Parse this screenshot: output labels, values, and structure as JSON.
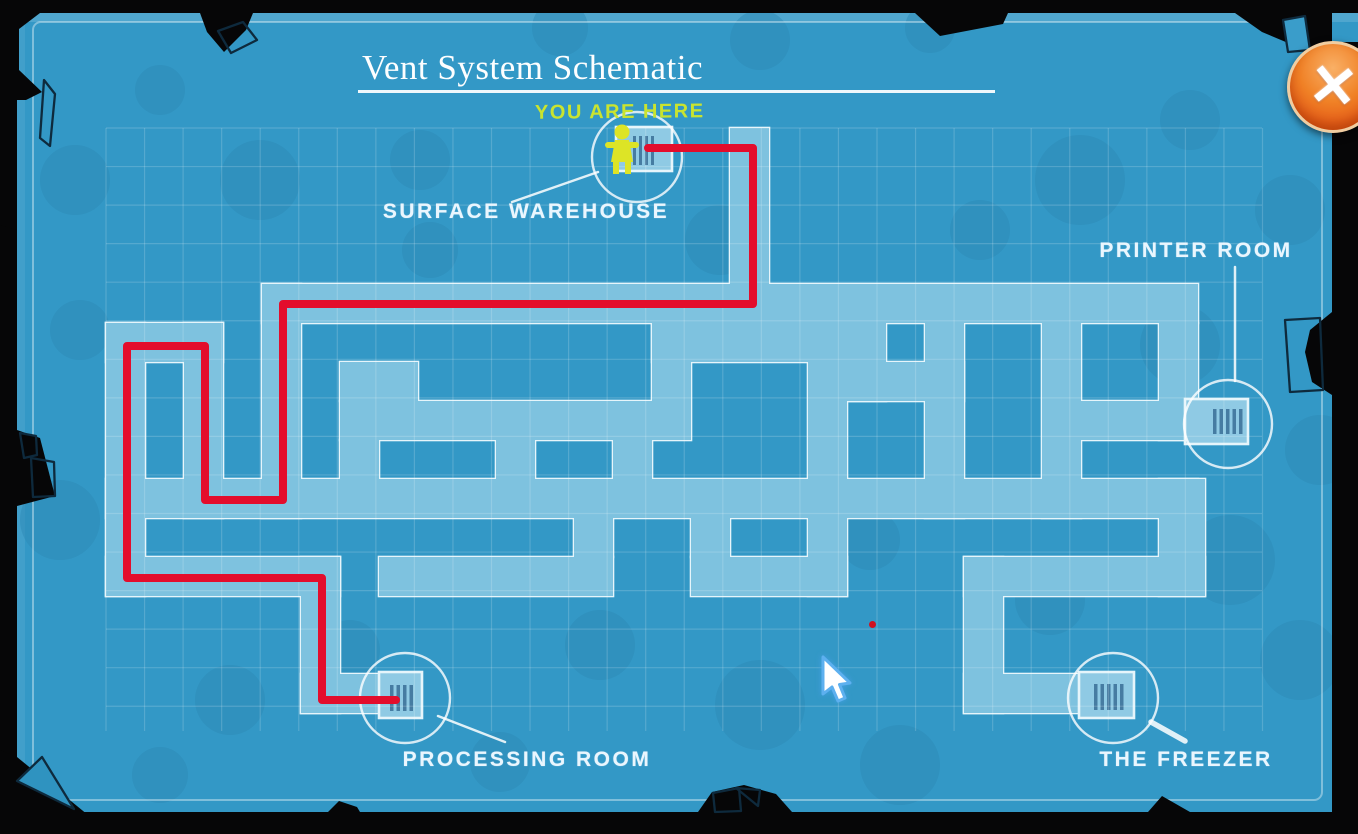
{
  "title": "Vent System Schematic",
  "you_are_here_label": "YOU ARE HERE",
  "rooms": {
    "surface_warehouse": "SURFACE WAREHOUSE",
    "printer_room": "PRINTER ROOM",
    "processing_room": "PROCESSING ROOM",
    "the_freezer": "THE FREEZER"
  },
  "close_button": {
    "symbol": "✕"
  },
  "colors": {
    "sheet": "#3398c6",
    "blob": "#2d89b6",
    "corridor": "#7ec2df",
    "corridor_outline": "#e6f5fb",
    "grid": "rgba(255,255,255,0.17)",
    "vent_fill": "#8fcae4",
    "slat": "#3a6e96",
    "circle_stroke": "rgba(255,255,255,0.8)",
    "route_red": "#e30d2c",
    "label_white": "#eaf6fe",
    "you_are_here_green": "#c9e42f",
    "close_orange": "#f08126",
    "black_edge": "#060607",
    "character_green": "#dde426"
  },
  "maze": {
    "corridors": [
      [
        730,
        128,
        39,
        195
      ],
      [
        262,
        284,
        936,
        39
      ],
      [
        262,
        284,
        39,
        234
      ],
      [
        106,
        323,
        117,
        39
      ],
      [
        106,
        323,
        39,
        273
      ],
      [
        184,
        323,
        39,
        195
      ],
      [
        340,
        362,
        78,
        39
      ],
      [
        340,
        401,
        312,
        39
      ],
      [
        652,
        323,
        39,
        117
      ],
      [
        652,
        323,
        195,
        39
      ],
      [
        808,
        362,
        39,
        234
      ],
      [
        847,
        323,
        39,
        78
      ],
      [
        847,
        362,
        117,
        39
      ],
      [
        925,
        323,
        39,
        195
      ],
      [
        1042,
        323,
        39,
        195
      ],
      [
        1159,
        323,
        39,
        117
      ],
      [
        1081,
        401,
        104,
        39
      ],
      [
        106,
        479,
        1092,
        39
      ],
      [
        340,
        440,
        39,
        39
      ],
      [
        496,
        440,
        39,
        39
      ],
      [
        613,
        440,
        39,
        39
      ],
      [
        574,
        518,
        39,
        39
      ],
      [
        691,
        518,
        39,
        39
      ],
      [
        106,
        557,
        234,
        39
      ],
      [
        301,
        557,
        39,
        156
      ],
      [
        301,
        674,
        117,
        39
      ],
      [
        379,
        557,
        234,
        39
      ],
      [
        691,
        557,
        156,
        39
      ],
      [
        964,
        557,
        241,
        39
      ],
      [
        1159,
        479,
        46,
        117
      ],
      [
        964,
        557,
        39,
        156
      ],
      [
        964,
        674,
        117,
        39
      ]
    ],
    "vent_squares": [
      {
        "id": "surface-warehouse",
        "rect": [
          616,
          127,
          56,
          44
        ],
        "slats": [
          633,
          136,
          3,
          29,
          4,
          6
        ]
      },
      {
        "id": "printer-room",
        "rect": [
          1185,
          399,
          63,
          45
        ],
        "slats": [
          1213,
          409,
          3.5,
          25,
          5,
          6.5
        ]
      },
      {
        "id": "processing-room",
        "rect": [
          379,
          672,
          43,
          46
        ],
        "slats": [
          390,
          685,
          3.5,
          26,
          4,
          6.5
        ]
      },
      {
        "id": "the-freezer",
        "rect": [
          1079,
          672,
          55,
          46
        ],
        "slats": [
          1094,
          684,
          3.5,
          26,
          5,
          6.5
        ]
      }
    ],
    "location_circles": [
      {
        "id": "surface-warehouse",
        "c": [
          637,
          157,
          45
        ]
      },
      {
        "id": "printer-room",
        "c": [
          1228,
          424,
          44
        ]
      },
      {
        "id": "processing-room",
        "c": [
          405,
          698,
          45
        ]
      },
      {
        "id": "the-freezer",
        "c": [
          1113,
          698,
          45
        ]
      }
    ],
    "pointer_lines": [
      [
        598,
        172,
        512,
        202,
        2.5
      ],
      [
        1235,
        267,
        1235,
        381,
        2.5
      ],
      [
        438,
        716,
        505,
        742,
        2.5
      ],
      [
        1151,
        722,
        1185,
        741,
        5.5
      ]
    ]
  },
  "route": {
    "color": "#e30d2c",
    "width": 8,
    "points": [
      [
        648,
        148
      ],
      [
        753,
        148
      ],
      [
        753,
        304
      ],
      [
        283,
        304
      ],
      [
        283,
        500
      ],
      [
        205,
        500
      ],
      [
        205,
        346
      ],
      [
        127,
        346
      ],
      [
        127,
        578
      ],
      [
        322,
        578
      ],
      [
        322,
        700
      ],
      [
        396,
        700
      ]
    ]
  },
  "red_dot": [
    869,
    621
  ],
  "cursor": [
    816,
    654
  ],
  "character": [
    605,
    121
  ]
}
